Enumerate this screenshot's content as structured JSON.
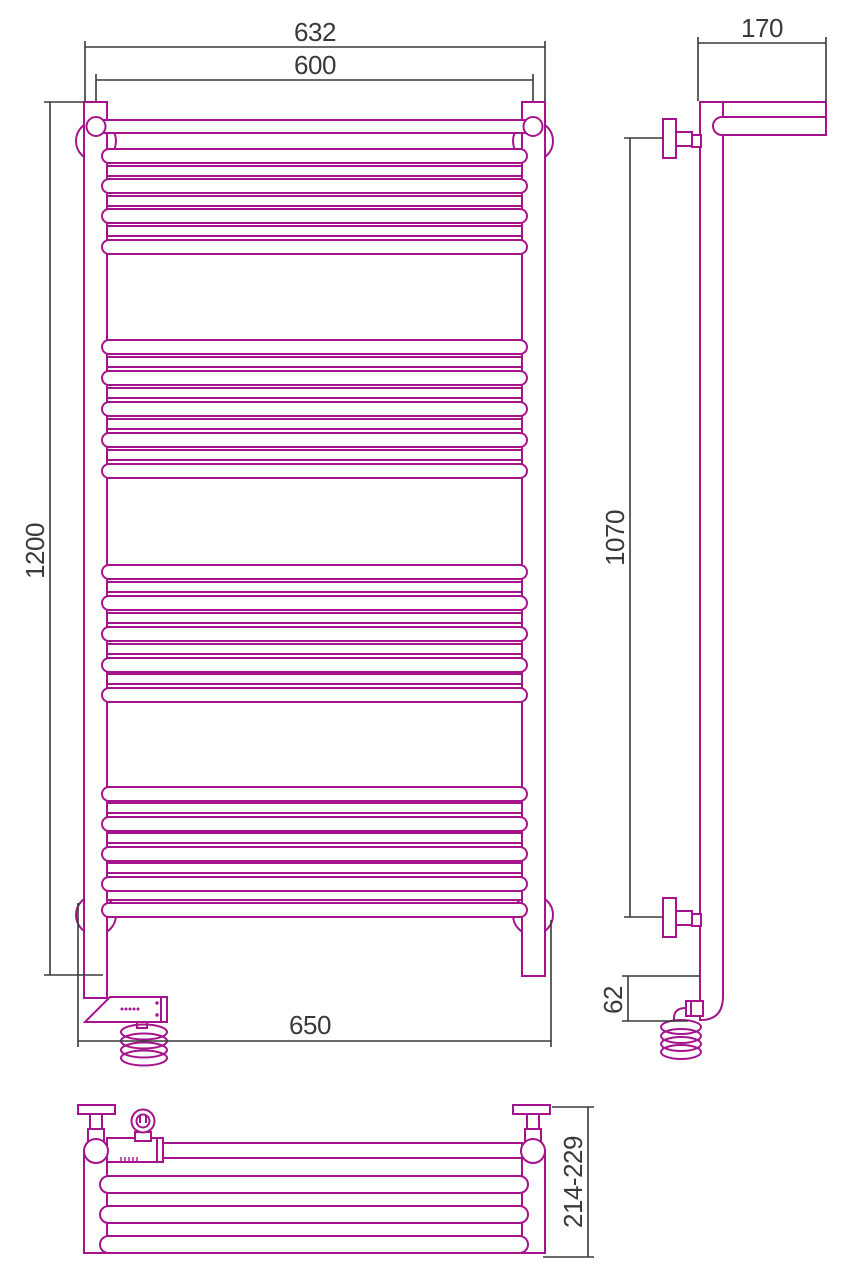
{
  "drawing": {
    "kind": "towel-rail-technical-drawing",
    "views": {
      "front": "front-view",
      "side": "side-view",
      "plan": "bottom-view"
    }
  },
  "dimensions": {
    "overall_width": "632",
    "center_width": "600",
    "height": "1200",
    "bottom_width": "650",
    "depth_top": "170",
    "bracket_span": "1070",
    "bottom_offset": "62",
    "wall_depth_range": "214-229"
  },
  "colors": {
    "product": "#a5148c",
    "dimension": "#3a3a3a",
    "background": "#ffffff"
  }
}
